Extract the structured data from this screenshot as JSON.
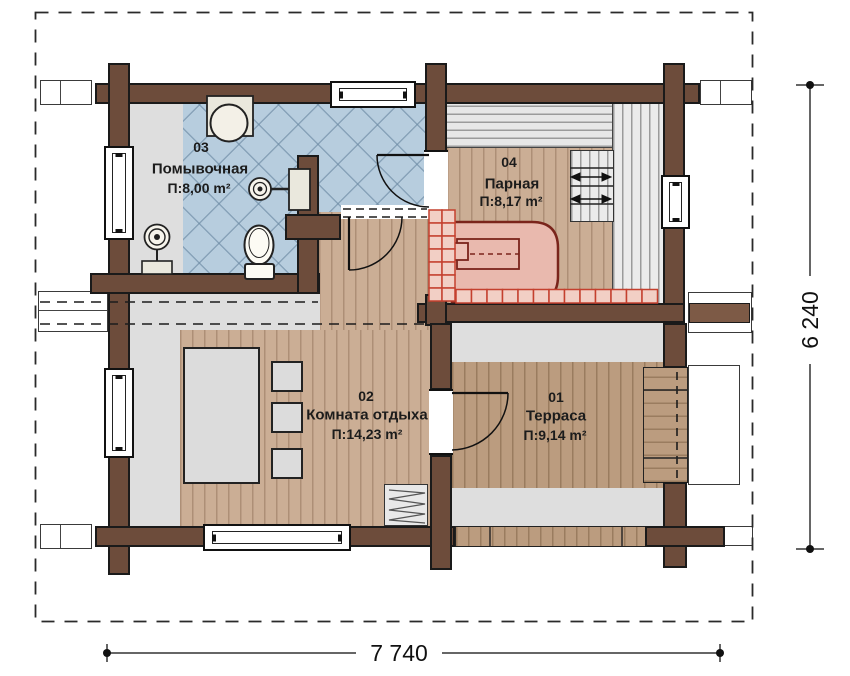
{
  "plan": {
    "rooms": [
      {
        "number": "03",
        "name": "Помывочная",
        "area": "П:8,00 m²"
      },
      {
        "number": "04",
        "name": "Парная",
        "area": "П:8,17 m²"
      },
      {
        "number": "02",
        "name": "Комната отдыха",
        "area": "П:14,23 m²"
      },
      {
        "number": "01",
        "name": "Терраса",
        "area": "П:9,14 m²"
      }
    ],
    "dimensions": {
      "width": "7 740",
      "height": "6 240"
    },
    "symbols": [
      "font-symbol",
      "shower-symbol",
      "toilet-symbol",
      "mixer-symbol",
      "stove-symbol",
      "bench",
      "steps-symbol",
      "hatch-symbol",
      "table",
      "chair",
      "window",
      "door-arc"
    ],
    "colors": {
      "wall": "#6d4c3b",
      "wallOutline": "#1a1a1a",
      "tile": "#b7cdde",
      "grayZone": "#dedede",
      "benchLine": "#9b9b9b",
      "wood": "#cbae95",
      "woodLine": "#ad8f76",
      "terraceWood": "#bb9c7f",
      "terraceWoodLine": "#9a7c5f",
      "stove": "#e9b9ae",
      "stoveOutline": "#7a241b",
      "brick": "#f2cfc5",
      "brickLine": "#c4402e",
      "furniture": "#dcdcdc",
      "ink": "#1c1c1c"
    }
  }
}
